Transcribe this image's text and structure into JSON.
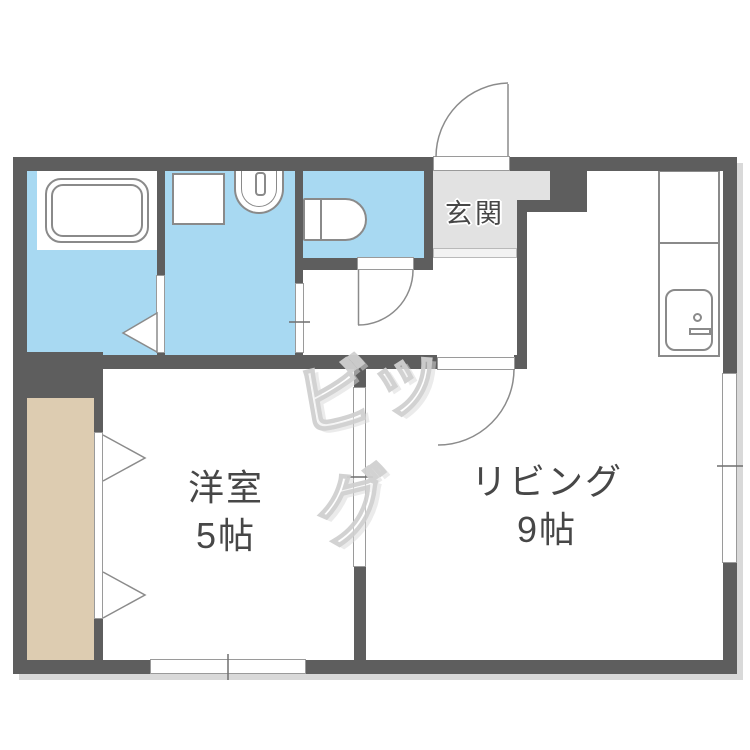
{
  "plan_type": "japanese-apartment-floor-plan",
  "rooms": {
    "entrance": {
      "label": "玄関"
    },
    "living": {
      "label": "リビング",
      "size": "9帖"
    },
    "western": {
      "label": "洋室",
      "size": "5帖"
    }
  },
  "watermark": {
    "text": "ビッグ"
  },
  "fixtures": [
    "bathtub",
    "washing-machine-pan",
    "washbasin",
    "toilet",
    "kitchen-counter",
    "kitchen-sink",
    "closet"
  ],
  "colors": {
    "wall": "#5e5e5e",
    "wet_room": "#a8d9f2",
    "entrance_floor": "#e2e2e2",
    "closet_floor": "#ddccb1",
    "label_text": "#474747",
    "fixture_line": "#8a8a8a",
    "shadow": "#d9d9d9",
    "watermark": "#d0d0d0"
  }
}
